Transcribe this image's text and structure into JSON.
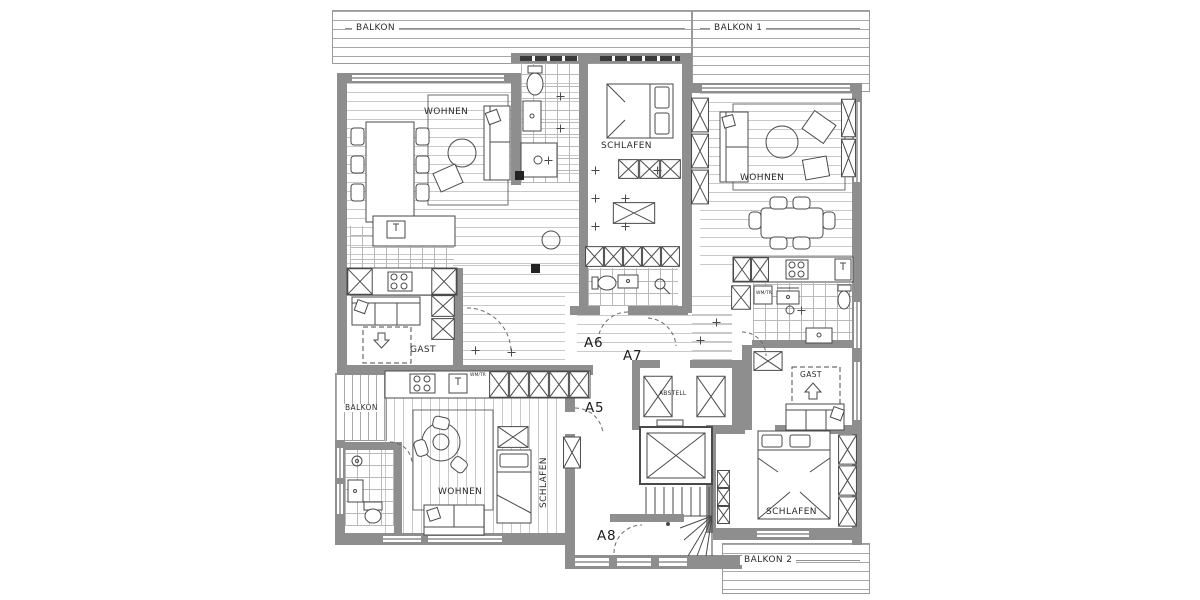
{
  "plan": {
    "balconies": {
      "top_left": "BALKON",
      "top_right": "BALKON 1",
      "bottom_right": "BALKON 2",
      "side_small": "BALKON"
    },
    "apartment_labels": {
      "a5": "A5",
      "a6": "A6",
      "a7": "A7",
      "a8": "A8"
    },
    "room_labels": {
      "a6_living": "WOHNEN",
      "a6_bedroom": "SCHLAFEN",
      "a6_guest": "GAST",
      "a7_living": "WOHNEN",
      "a7_guest": "GAST",
      "a7_bedroom": "SCHLAFEN",
      "a5_living": "WOHNEN",
      "a5_bedroom": "SCHLAFEN",
      "storage": "ABSTELL",
      "laundry_left": "WM/TR",
      "laundry_right": "WM/TR"
    },
    "colors": {
      "wall": "#8e8e8e",
      "line": "#4a4a4a",
      "hatch": "#c9c9c9",
      "background": "#ffffff"
    }
  }
}
